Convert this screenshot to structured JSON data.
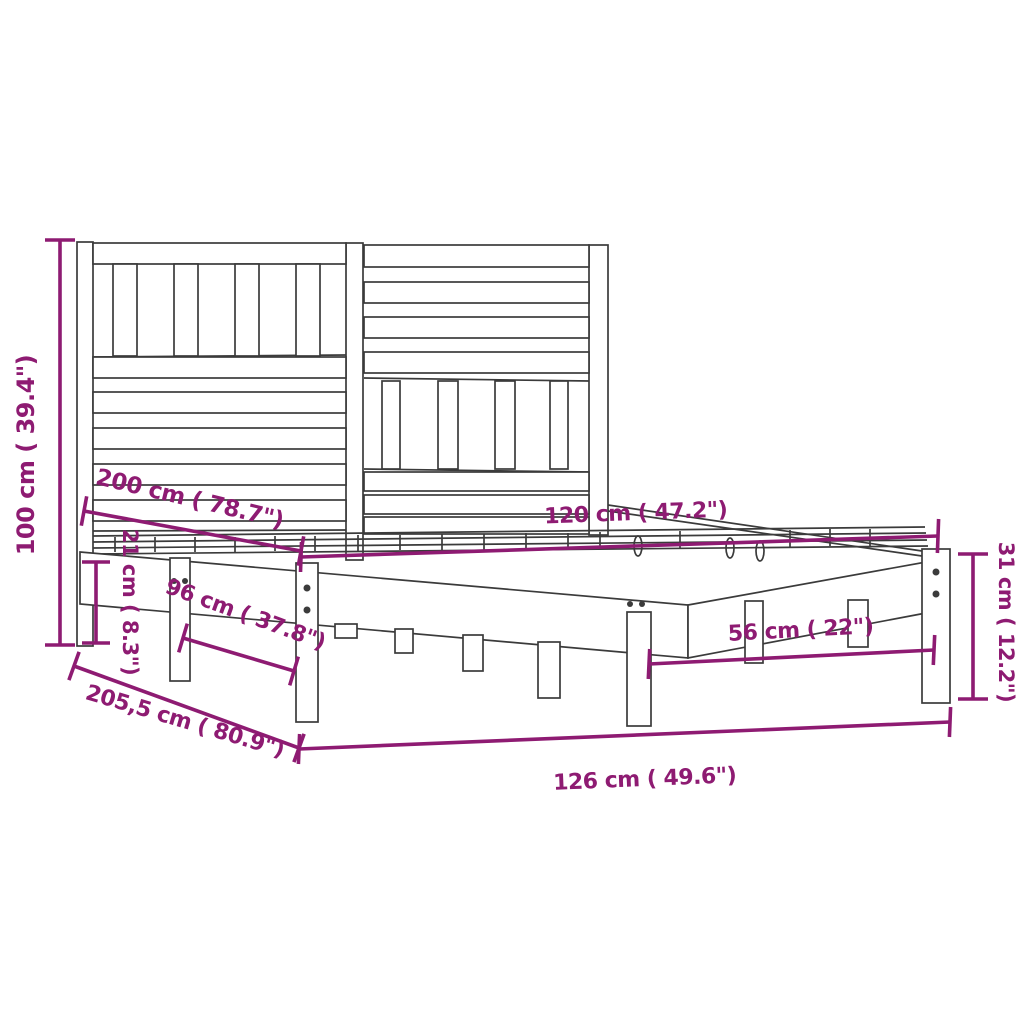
{
  "diagram": {
    "kind": "bed-frame-with-headboard dimension diagram",
    "colors": {
      "dimension_accent": "#8E1B72",
      "drawing_line": "#3B3B3B",
      "background": "#FFFFFF"
    },
    "dimensions": {
      "headboard_height": "100 cm ( 39.4\")",
      "underbed_clearance": "21 cm ( 8.3\")",
      "mattress_length": "200 cm ( 78.7\")",
      "mattress_width": "120 cm ( 47.2\")",
      "support_spacing_head": "96 cm ( 37.8\")",
      "support_spacing_foot": "56 cm ( 22\")",
      "side_rail_height": "31 cm ( 12.2\")",
      "frame_total_length": "205,5 cm ( 80.9\")",
      "frame_total_width": "126 cm ( 49.6\")"
    }
  }
}
